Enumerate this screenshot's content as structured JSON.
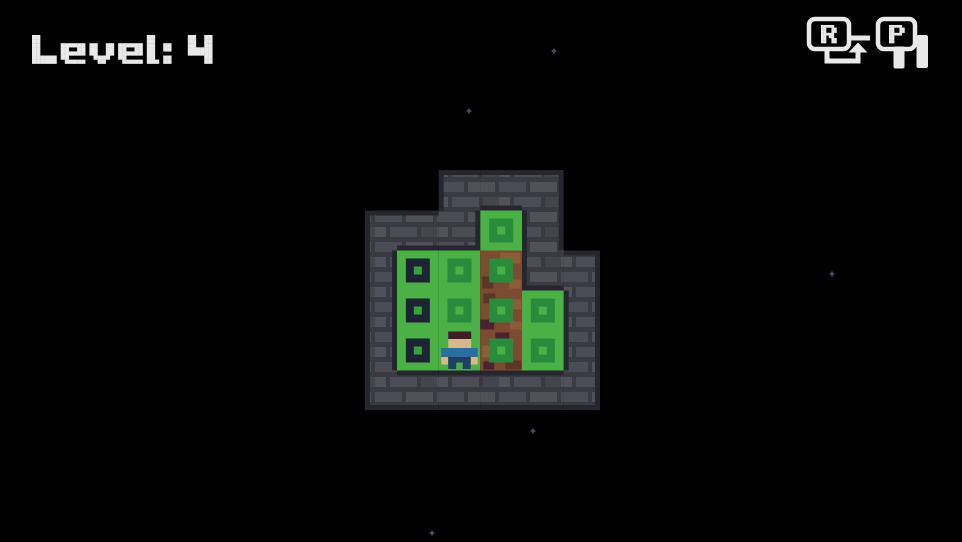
{
  "hud": {
    "level_label": "Level:4",
    "restart_key": "R",
    "restart_label": "Restart (R)",
    "pause_key": "P",
    "pause_label": "Pause (P)"
  },
  "board": {
    "map": [
      "..WWW.",
      "WWWMW.",
      "WHMDWW",
      "WHMDMW",
      "WHPDMW",
      "WWWWWW"
    ],
    "legend": {
      "W": "wall",
      ".": "empty-sky",
      "M": "grass-with-bush-marker",
      "H": "grass-with-hole",
      "D": "dirt-with-bush-marker",
      "P": "grass-with-player",
      "G": "grass"
    },
    "player": {
      "row": 4,
      "col": 2
    }
  },
  "stars": [
    [
      554,
      51
    ],
    [
      469,
      111
    ],
    [
      832,
      274
    ],
    [
      533,
      431
    ],
    [
      432,
      533
    ]
  ],
  "colors": {
    "background": "#000000",
    "text": "#e9e9e9",
    "wall_outline": "#26262e",
    "wall_mortar": "#3a3a43",
    "wall_brick": "#4c4c56",
    "wall_brick_light": "#51515a",
    "wall_brick_dark": "#45454e",
    "grass": "#4bb046",
    "marker_green": "#288c3c",
    "hole_navy": "#1b2531",
    "hole_center": "#3aa23a",
    "dirt": "#7c4b31",
    "dirt_light": "#8d5c39",
    "dirt_dark": "#5d3526",
    "dirt_maroon": "#4d2130",
    "player_hair": "#411c2b",
    "player_skin": "#d8b98b",
    "player_shirt": "#2a6f9d",
    "player_pants": "#1e3f66",
    "star": "#42536a"
  }
}
